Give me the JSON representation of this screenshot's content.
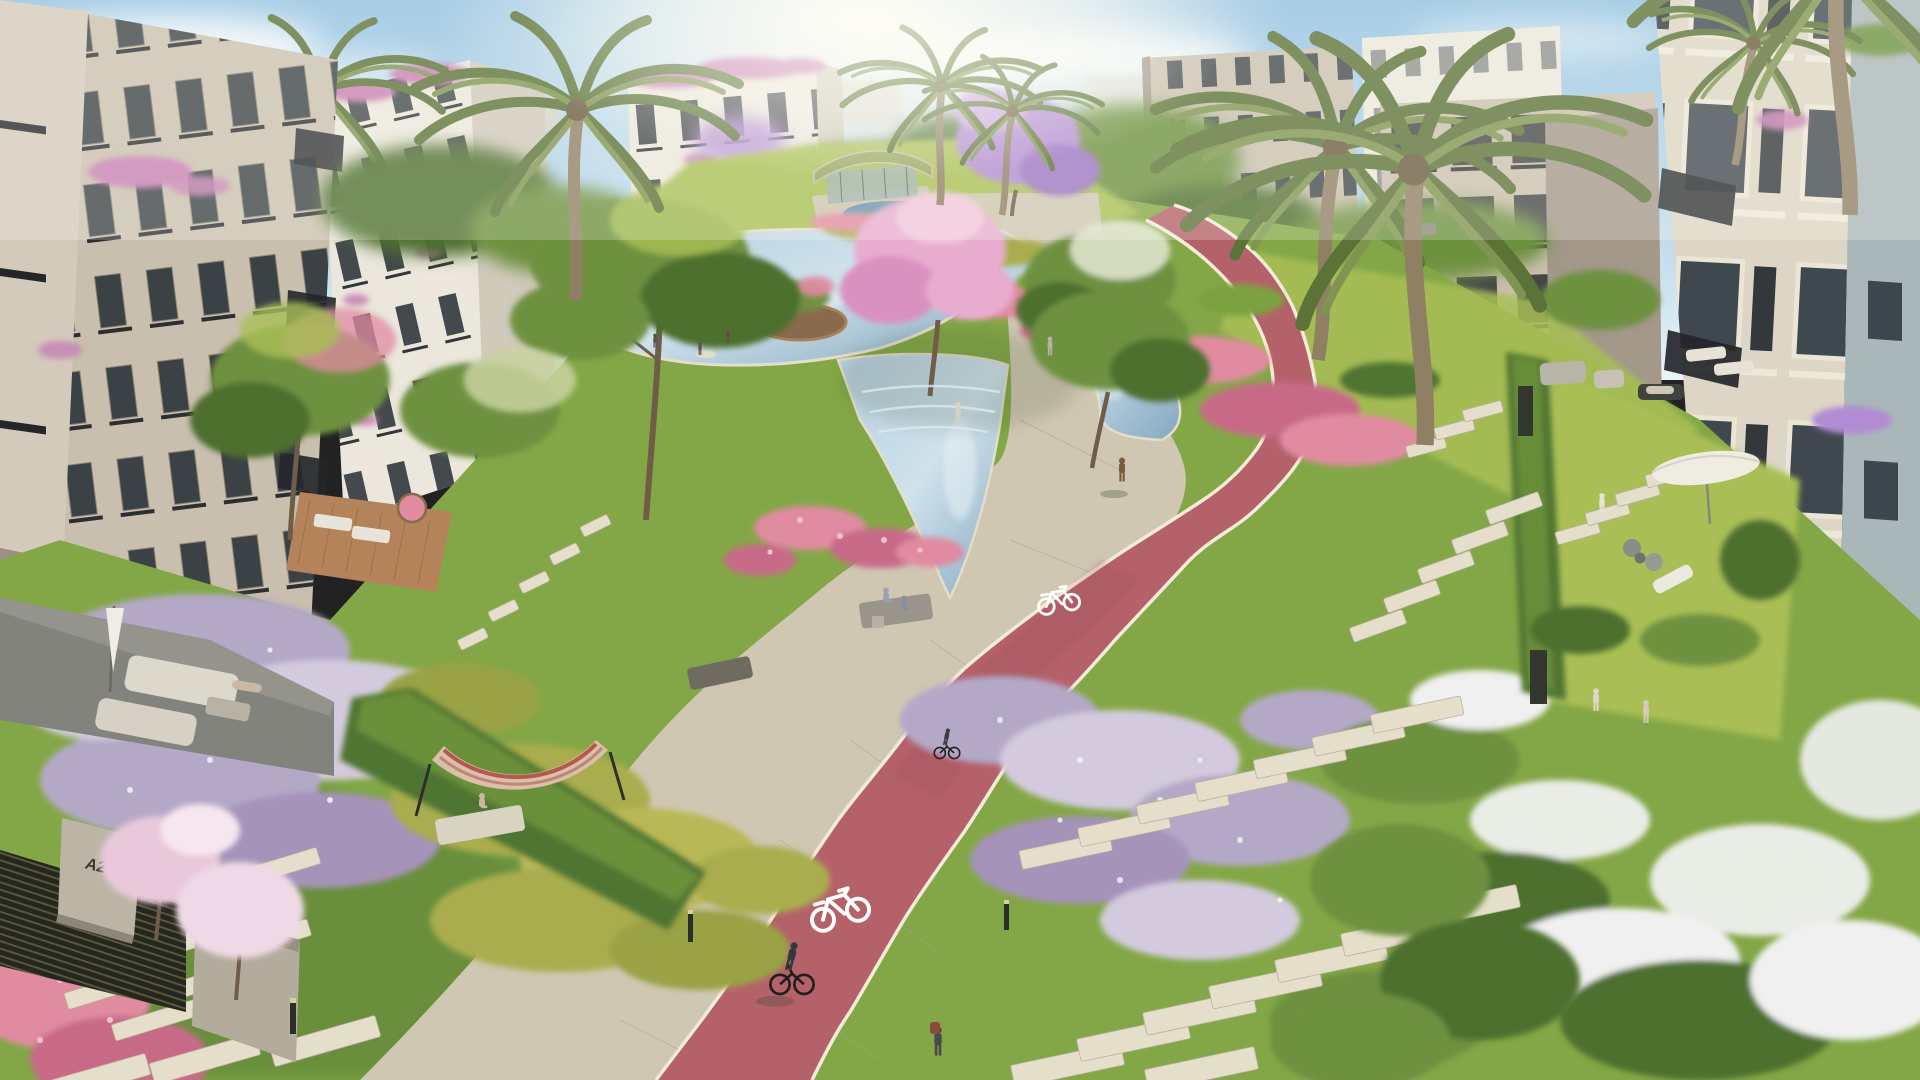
{
  "labels": {
    "gate_plate": "A2-2"
  },
  "icons": {
    "lane_marking": "bicycle-icon"
  },
  "colors": {
    "sky_top": "#8fc0e2",
    "sky_horizon": "#eaf4f8",
    "sun_glow": "#fffdf4",
    "cloud_white": "#ffffff",
    "building_beige": "#c9bfae",
    "building_beige_shade": "#a2968a",
    "building_white": "#ebe7dc",
    "building_white_shade": "#d0cabb",
    "building_wall_shade": "#a3988a",
    "building_blue_grey": "#a9b7b9",
    "window_glass": "#343b41",
    "railing_dark": "#24262a",
    "roof_flower_pink": "#c77fb4",
    "water_blue": "#b5cfdf",
    "water_deep": "#84a8c0",
    "pool_teal": "#5e8fae",
    "walkway_beige": "#cfc7b2",
    "walkway_shade": "#b6ae9a",
    "track_red": "#b5616a",
    "track_red_shade": "#9d4f58",
    "lane_line_white": "#f2ecd8",
    "lawn_green": "#83a746",
    "lawn_light": "#a9bf55",
    "lawn_dark": "#5e8637",
    "hedge_green": "#4f7433",
    "hedge_light": "#7ca23f",
    "shrub_olive": "#a9ad4d",
    "flower_pink": "#e18ba1",
    "flower_pink_deep": "#c86a87",
    "flower_lavender": "#b4a8c7",
    "flower_lavender_light": "#d3cbdd",
    "flower_white": "#eff0ef",
    "blossom_pink": "#e8accf",
    "jacaranda_purple": "#b18bd3",
    "tree_green": "#6e913f",
    "tree_green_dark": "#4d6f2f",
    "trunk_brown": "#6f5c49",
    "palm_green": "#7e9450",
    "palm_green_dark": "#5b7337",
    "stone_white": "#e5decb",
    "deck_wood": "#b5835a",
    "umbrella_white": "#efece2",
    "shadow_green": "#2a3a20"
  },
  "scene": {
    "description": "Aerial architectural render of a residential compound: beige apartment buildings around a landscaped park with a winding red cycling track, beige pedestrian promenade, water canals with planted islands, a pavilion, flower beds, palm trees, stepping stones, benches and people.",
    "elements": [
      "apartment-buildings",
      "palm-trees",
      "lawns",
      "flower-beds",
      "water-canal",
      "pond-islands",
      "pavilion",
      "promenade",
      "red-bike-track",
      "bike-lane-markings",
      "stepping-stones",
      "hedges",
      "benches",
      "hammock",
      "patio-sofa",
      "garden-umbrellas",
      "gate-with-plate",
      "bollard-lights",
      "pedestrians",
      "cyclists"
    ],
    "people": {
      "pedestrians": 10,
      "cyclists": 2,
      "seated": 5
    },
    "bike_lane_markings": 2
  }
}
